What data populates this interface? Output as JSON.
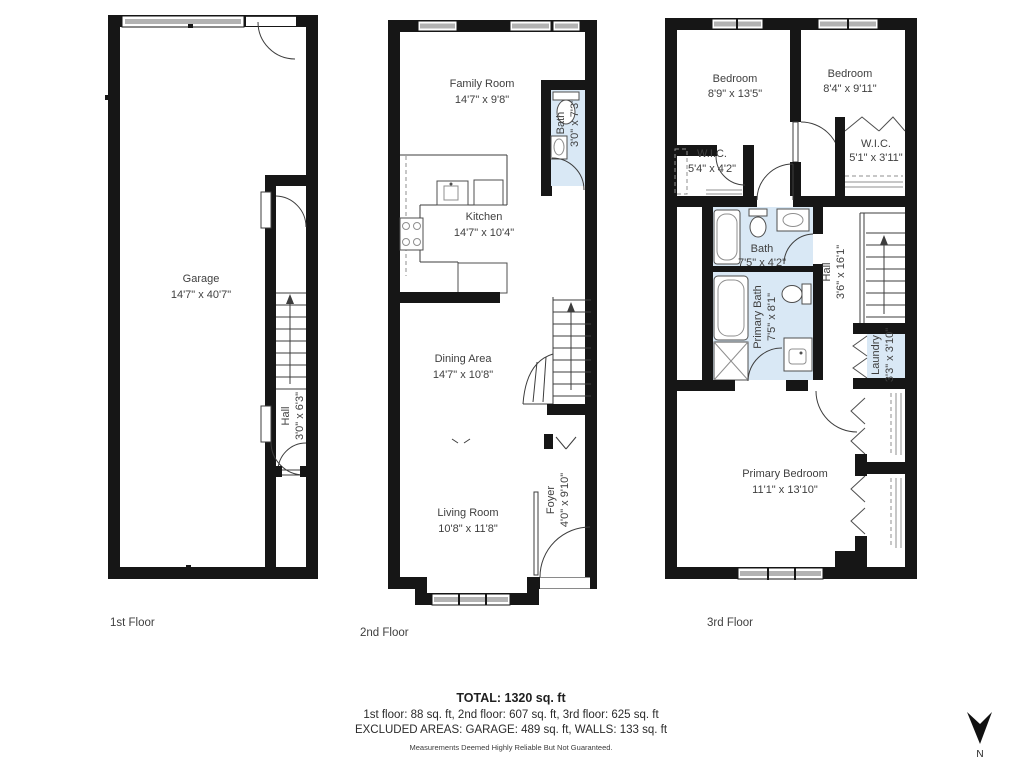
{
  "colors": {
    "wall": "#161616",
    "bath_fill": "#d9e8f5",
    "window_gray": "#b3b3b3",
    "label_text": "#3f3f3f"
  },
  "floors": [
    {
      "label": "1st Floor",
      "rooms": [
        {
          "name": "Garage",
          "dims": "14'7\" x 40'7\""
        },
        {
          "name": "Hall",
          "dims": "3'0\" x 6'3\""
        }
      ]
    },
    {
      "label": "2nd Floor",
      "rooms": [
        {
          "name": "Family Room",
          "dims": "14'7\" x 9'8\""
        },
        {
          "name": "Bath",
          "dims": "3'0\" x 7'3\""
        },
        {
          "name": "Kitchen",
          "dims": "14'7\" x 10'4\""
        },
        {
          "name": "Dining Area",
          "dims": "14'7\" x 10'8\""
        },
        {
          "name": "Living Room",
          "dims": "10'8\" x 11'8\""
        },
        {
          "name": "Foyer",
          "dims": "4'0\" x 9'10\""
        }
      ]
    },
    {
      "label": "3rd Floor",
      "rooms": [
        {
          "name": "Bedroom",
          "dims": "8'9\" x 13'5\""
        },
        {
          "name": "Bedroom",
          "dims": "8'4\" x 9'11\""
        },
        {
          "name": "W.I.C.",
          "dims": "5'4\" x 4'2\""
        },
        {
          "name": "W.I.C.",
          "dims": "5'1\" x 3'11\""
        },
        {
          "name": "Bath",
          "dims": "7'5\" x 4'2\""
        },
        {
          "name": "Primary Bath",
          "dims": "7'5\" x 8'1\""
        },
        {
          "name": "Hall",
          "dims": "3'6\" x 16'1\""
        },
        {
          "name": "Laundry",
          "dims": "3'3\" x 3'10\""
        },
        {
          "name": "Primary Bedroom",
          "dims": "11'1\" x 13'10\""
        }
      ]
    }
  ],
  "summary": {
    "total": "TOTAL: 1320 sq. ft",
    "floors_line": "1st floor: 88 sq. ft, 2nd floor: 607 sq. ft, 3rd floor: 625 sq. ft",
    "excluded_line": "EXCLUDED AREAS: GARAGE: 489 sq. ft, WALLS: 133 sq. ft",
    "disclaimer": "Measurements Deemed Highly Reliable But Not Guaranteed."
  },
  "compass": {
    "label": "N"
  }
}
